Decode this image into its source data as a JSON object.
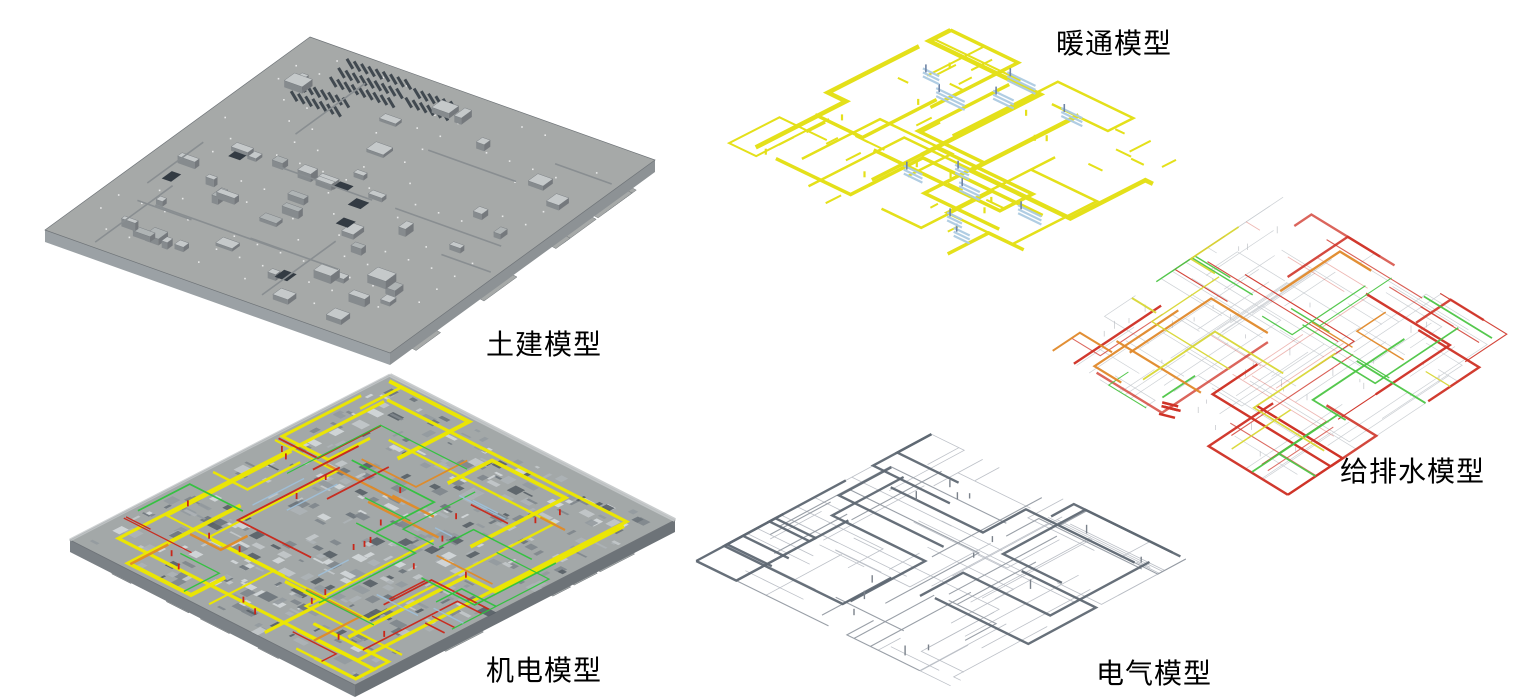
{
  "figure": {
    "background_color": "#ffffff",
    "text_color": "#000000"
  },
  "panels": [
    {
      "id": "civil",
      "label": "土建模型",
      "palette": {
        "slab_top": "#a6a9a8",
        "slab_side_right": "#8d9295",
        "slab_side_left": "#9ba1a5",
        "edge": "#6f7478",
        "block_light": "#c5c9ca",
        "block_mid": "#afb4b5",
        "block_side": "#75797d",
        "block_side2": "#868b8e",
        "pit_dark": "#333b43",
        "fin_dark": "#414950",
        "dot": "#f3f5f5",
        "wall": "#898e91"
      }
    },
    {
      "id": "mep",
      "label": "机电模型",
      "palette": {
        "base": "#a3a8a8",
        "rim": "#c4c8c9",
        "side": "#6d7378",
        "side2": "#7b8186",
        "edge": "#6e7378",
        "texture": [
          "#6d747b",
          "#7f868c",
          "#949a9f",
          "#adb2b6",
          "#c3c8ca",
          "#585f66",
          "#d4d8da"
        ],
        "pipe_yellow": "#ece700",
        "pipe_red": "#c92619",
        "pipe_green": "#2fc23c",
        "pipe_orange": "#e08a26",
        "pipe_blue": "#9fc0da"
      }
    },
    {
      "id": "hvac",
      "label": "暖通模型",
      "palette": {
        "duct_yellow": "#e4e01a",
        "component_blue": "#accae2",
        "component_dark": "#6e84a6"
      }
    },
    {
      "id": "plumbing",
      "label": "给排水模型",
      "palette": {
        "pipe_red": "#cf3327",
        "pipe_green": "#4cc544",
        "pipe_orange": "#e0892a",
        "pipe_yellow": "#d8d735",
        "wire_gray": "#c8ccd0",
        "drop_gray": "#b9bdc2"
      }
    },
    {
      "id": "electrical",
      "label": "电气模型",
      "palette": {
        "tray_dark": "#5f6873",
        "wire_mid": "#949aa2",
        "wire_light": "#b8bdc4",
        "drop": "#7b828b"
      }
    }
  ]
}
